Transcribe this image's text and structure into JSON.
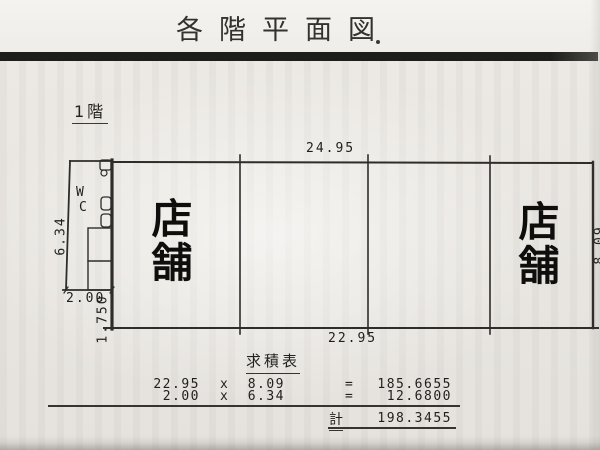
{
  "header": {
    "title": "各階平面図"
  },
  "floor_label": "1階",
  "plan": {
    "shop_left": "店舗",
    "shop_right": "店舗",
    "wc_line1": "W",
    "wc_line2": "C",
    "dim_top": "24.95",
    "dim_bottom": "22.95",
    "dim_left": "6.34",
    "dim_annex_width": "2.00",
    "dim_left_lower": "1.750",
    "dim_right": "8.09"
  },
  "table": {
    "title": "求積表",
    "rows": [
      {
        "factor1": "22.95",
        "op": "x",
        "factor2": "8.09",
        "equals": "=",
        "result": "185.6655"
      },
      {
        "factor1": "2.00",
        "op": "x",
        "factor2": "6.34",
        "equals": "=",
        "result": "12.6800"
      }
    ],
    "total_label": "計",
    "total_value": "198.3455"
  },
  "colors": {
    "ink": "#2e2d2a",
    "bar": "#1d1d1b",
    "paper": "#eae7e2"
  }
}
